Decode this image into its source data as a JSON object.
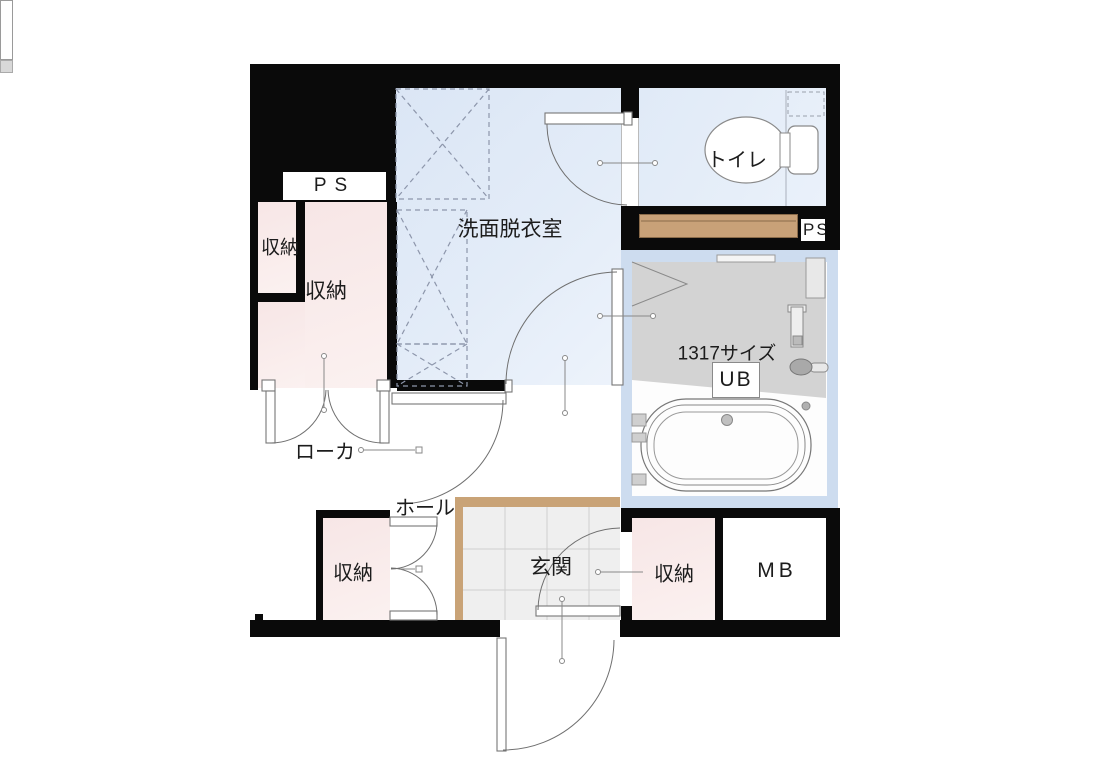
{
  "plan": {
    "type": "floor-plan",
    "rooms": {
      "washroom": {
        "label": "洗面脱衣室"
      },
      "toilet": {
        "label": "トイレ"
      },
      "unit_bath": {
        "size_label": "1317サイズ",
        "label": "UB"
      },
      "corridor": {
        "label": "ローカ"
      },
      "hall": {
        "label": "ホール"
      },
      "entrance": {
        "label": "玄関"
      },
      "storage_top_small": {
        "label": "収納"
      },
      "storage_top_large": {
        "label": "収納"
      },
      "storage_bottom_left": {
        "label": "収納"
      },
      "storage_bottom_right": {
        "label": "収納"
      },
      "pipe_space_top_left": {
        "label": "PS"
      },
      "pipe_space_right": {
        "label": "PS"
      },
      "meter_box": {
        "label": "MB"
      }
    },
    "colors": {
      "wall": "#0a0a0a",
      "washroom_floor": "#e0eaf7",
      "toilet_floor": "#e4edf8",
      "storage_floor": "#f8e9e8",
      "unit_bath_wall": "#cddcef",
      "unit_bath_floor": "#d3d3d3",
      "entrance_tile": "#efefef",
      "wood_shelf": "#c8a178",
      "entrance_step": "#c9a377",
      "dashed_line": "#8d96ab",
      "leader_line": "#888888"
    }
  }
}
